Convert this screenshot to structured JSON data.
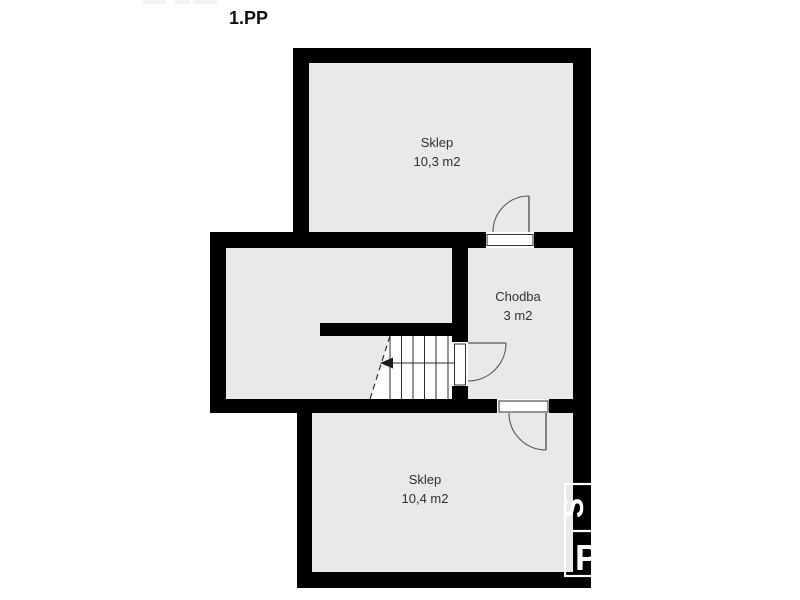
{
  "title": "1.PP",
  "rooms": {
    "sklep_top": {
      "name": "Sklep",
      "area": "10,3 m2"
    },
    "chodba": {
      "name": "Chodba",
      "area": "3 m2"
    },
    "sklep_bottom": {
      "name": "Sklep",
      "area": "10,4 m2"
    }
  },
  "watermark": {
    "letter_top": "Š",
    "letter_bottom": "P"
  },
  "colors": {
    "wall": "#000000",
    "room": "#e9e9e9",
    "bg": "#ffffff",
    "line": "#2e2e2e",
    "label": "#303030",
    "wm": "#ffffff"
  }
}
